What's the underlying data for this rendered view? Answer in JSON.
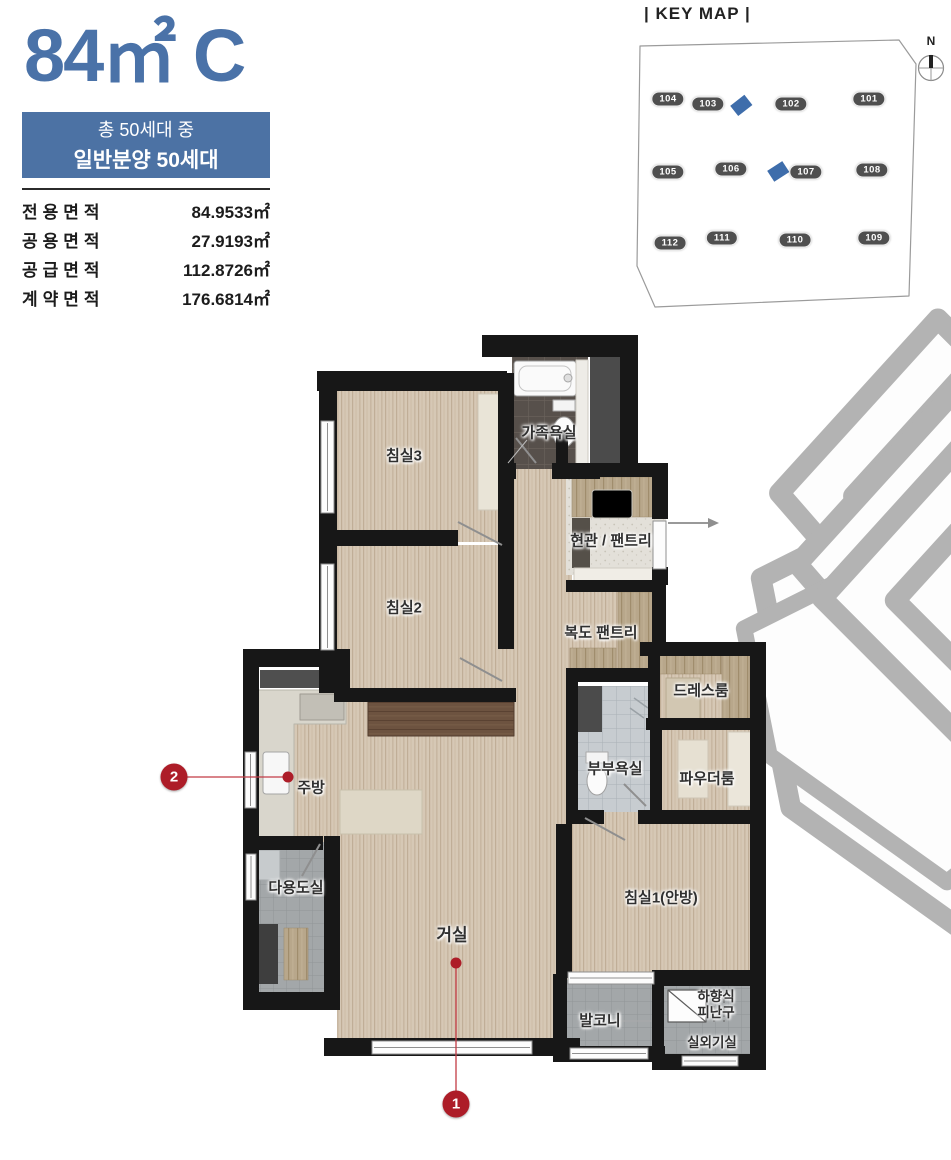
{
  "header": {
    "title": "84㎡ C",
    "badge": {
      "line1": "총 50세대 중",
      "line2": "일반분양 50세대"
    }
  },
  "area_table": {
    "rows": [
      {
        "label": "전용면적",
        "value": "84.9533㎡"
      },
      {
        "label": "공용면적",
        "value": "27.9193㎡"
      },
      {
        "label": "공급면적",
        "value": "112.8726㎡"
      },
      {
        "label": "계약면적",
        "value": "176.6814㎡"
      }
    ]
  },
  "keymap": {
    "title": "| KEY MAP |",
    "compass_label": "N",
    "buildings": [
      {
        "id": "104"
      },
      {
        "id": "103"
      },
      {
        "id": "102"
      },
      {
        "id": "101"
      },
      {
        "id": "105"
      },
      {
        "id": "106"
      },
      {
        "id": "107"
      },
      {
        "id": "108"
      },
      {
        "id": "112"
      },
      {
        "id": "111"
      },
      {
        "id": "110"
      },
      {
        "id": "109"
      }
    ],
    "highlighted_buildings": [
      "103",
      "107"
    ]
  },
  "floorplan": {
    "rooms": {
      "bedroom3": "침실3",
      "family_bath": "가족욕실",
      "entrance_pantry": "현관 / 팬트리",
      "bedroom2": "침실2",
      "corridor_pantry": "복도 팬트리",
      "dress_room": "드레스룸",
      "master_bath": "부부욕실",
      "powder_room": "파우더룸",
      "kitchen": "주방",
      "utility": "다용도실",
      "living": "거실",
      "bedroom1": "침실1(안방)",
      "balcony": "발코니",
      "evac_hatch_line1": "하향식",
      "evac_hatch_line2": "피난구",
      "outdoor_unit": "실외기실"
    },
    "markers": {
      "m1": "1",
      "m2": "2"
    }
  },
  "colors": {
    "accent_blue": "#4a72a8",
    "badge_blue": "#4c72a4",
    "marker_red": "#ad1d28",
    "keymap_highlight": "#3e6dab",
    "wall_black": "#171717"
  }
}
